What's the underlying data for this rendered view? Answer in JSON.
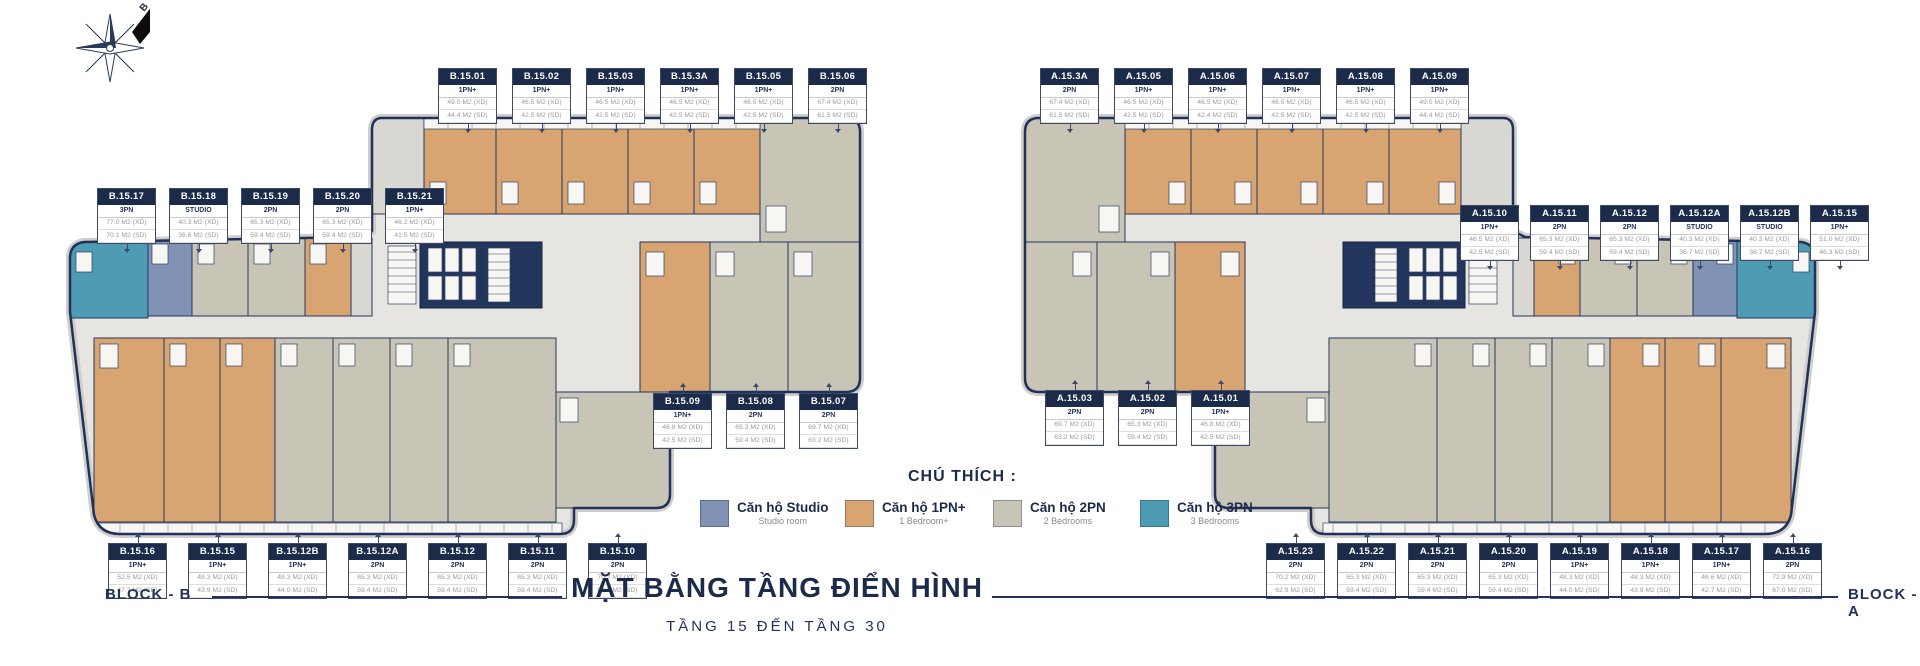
{
  "title": {
    "main": "MẶT BẰNG TẦNG ĐIỂN HÌNH",
    "subtitle": "TẦNG 15 ĐẾN TẦNG 30"
  },
  "compass": {
    "north_label": "B"
  },
  "legend": {
    "title": "CHÚ THÍCH :",
    "items": [
      {
        "name": "studio",
        "color": "#8093b4",
        "label_vi": "Căn hộ Studio",
        "label_en": "Studio room"
      },
      {
        "name": "1pn",
        "color": "#d8a471",
        "label_vi": "Căn hộ 1PN+",
        "label_en": "1 Bedroom+"
      },
      {
        "name": "2pn",
        "color": "#c9c5b6",
        "label_vi": "Căn hộ 2PN",
        "label_en": "2 Bedrooms"
      },
      {
        "name": "3pn",
        "color": "#4d9cb3",
        "label_vi": "Căn hộ 3PN",
        "label_en": "3 Bedrooms"
      }
    ]
  },
  "colors": {
    "accent_navy": "#1c2b4a",
    "wall": "#20315a"
  },
  "blocks": {
    "b": {
      "name": "BLOCK - B",
      "groups": {
        "top": [
          {
            "id": "B.15.01",
            "type": "1PN+",
            "area_xd": "49.0 M2 (XD)",
            "area_sd": "44.4 M2 (SD)"
          },
          {
            "id": "B.15.02",
            "type": "1PN+",
            "area_xd": "46.5 M2 (XD)",
            "area_sd": "42.5 M2 (SD)"
          },
          {
            "id": "B.15.03",
            "type": "1PN+",
            "area_xd": "46.5 M2 (XD)",
            "area_sd": "42.5 M2 (SD)"
          },
          {
            "id": "B.15.3A",
            "type": "1PN+",
            "area_xd": "46.5 M2 (XD)",
            "area_sd": "42.5 M2 (SD)"
          },
          {
            "id": "B.15.05",
            "type": "1PN+",
            "area_xd": "46.5 M2 (XD)",
            "area_sd": "42.5 M2 (SD)"
          },
          {
            "id": "B.15.06",
            "type": "2PN",
            "area_xd": "67.4 M2 (XD)",
            "area_sd": "61.5 M2 (SD)"
          }
        ],
        "left": [
          {
            "id": "B.15.17",
            "type": "3PN",
            "area_xd": "77.0 M2 (XD)",
            "area_sd": "70.1 M2 (SD)"
          },
          {
            "id": "B.15.18",
            "type": "STUDIO",
            "area_xd": "40.3 M2 (XD)",
            "area_sd": "36.6 M2 (SD)"
          },
          {
            "id": "B.15.19",
            "type": "2PN",
            "area_xd": "65.3 M2 (XD)",
            "area_sd": "59.4 M2 (SD)"
          },
          {
            "id": "B.15.20",
            "type": "2PN",
            "area_xd": "65.3 M2 (XD)",
            "area_sd": "59.4 M2 (SD)"
          },
          {
            "id": "B.15.21",
            "type": "1PN+",
            "area_xd": "46.2 M2 (XD)",
            "area_sd": "41.5 M2 (SD)"
          }
        ],
        "middle": [
          {
            "id": "B.15.09",
            "type": "1PN+",
            "area_xd": "46.8 M2 (XD)",
            "area_sd": "42.5 M2 (SD)"
          },
          {
            "id": "B.15.08",
            "type": "2PN",
            "area_xd": "65.3 M2 (XD)",
            "area_sd": "59.4 M2 (SD)"
          },
          {
            "id": "B.15.07",
            "type": "2PN",
            "area_xd": "69.7 M2 (XD)",
            "area_sd": "63.2 M2 (SD)"
          }
        ],
        "bottom": [
          {
            "id": "B.15.16",
            "type": "1PN+",
            "area_xd": "52.5 M2 (XD)",
            "area_sd": "47.7 M2 (SD)"
          },
          {
            "id": "B.15.15",
            "type": "1PN+",
            "area_xd": "48.3 M2 (XD)",
            "area_sd": "43.9 M2 (SD)"
          },
          {
            "id": "B.15.12B",
            "type": "1PN+",
            "area_xd": "48.3 M2 (XD)",
            "area_sd": "44.0 M2 (SD)"
          },
          {
            "id": "B.15.12A",
            "type": "2PN",
            "area_xd": "65.3 M2 (XD)",
            "area_sd": "59.4 M2 (SD)"
          },
          {
            "id": "B.15.12",
            "type": "2PN",
            "area_xd": "65.3 M2 (XD)",
            "area_sd": "59.4 M2 (SD)"
          },
          {
            "id": "B.15.11",
            "type": "2PN",
            "area_xd": "65.3 M2 (XD)",
            "area_sd": "59.4 M2 (SD)"
          },
          {
            "id": "B.15.10",
            "type": "2PN",
            "area_xd": "70.2 M2 (XD)",
            "area_sd": "62.9 M2 (SD)"
          }
        ]
      }
    },
    "a": {
      "name": "BLOCK - A",
      "groups": {
        "top": [
          {
            "id": "A.15.3A",
            "type": "2PN",
            "area_xd": "67.4 M2 (XD)",
            "area_sd": "61.5 M2 (SD)"
          },
          {
            "id": "A.15.05",
            "type": "1PN+",
            "area_xd": "46.5 M2 (XD)",
            "area_sd": "42.5 M2 (SD)"
          },
          {
            "id": "A.15.06",
            "type": "1PN+",
            "area_xd": "46.5 M2 (XD)",
            "area_sd": "42.4 M2 (SD)"
          },
          {
            "id": "A.15.07",
            "type": "1PN+",
            "area_xd": "46.5 M2 (XD)",
            "area_sd": "42.5 M2 (SD)"
          },
          {
            "id": "A.15.08",
            "type": "1PN+",
            "area_xd": "46.5 M2 (XD)",
            "area_sd": "42.5 M2 (SD)"
          },
          {
            "id": "A.15.09",
            "type": "1PN+",
            "area_xd": "49.0 M2 (XD)",
            "area_sd": "44.4 M2 (SD)"
          }
        ],
        "right": [
          {
            "id": "A.15.10",
            "type": "1PN+",
            "area_xd": "46.5 M2 (XD)",
            "area_sd": "42.5 M2 (SD)"
          },
          {
            "id": "A.15.11",
            "type": "2PN",
            "area_xd": "65.3 M2 (XD)",
            "area_sd": "59.4 M2 (SD)"
          },
          {
            "id": "A.15.12",
            "type": "2PN",
            "area_xd": "65.3 M2 (XD)",
            "area_sd": "59.4 M2 (SD)"
          },
          {
            "id": "A.15.12A",
            "type": "STUDIO",
            "area_xd": "40.3 M2 (XD)",
            "area_sd": "36.7 M2 (SD)"
          },
          {
            "id": "A.15.12B",
            "type": "STUDIO",
            "area_xd": "40.3 M2 (XD)",
            "area_sd": "36.7 M2 (SD)"
          },
          {
            "id": "A.15.15",
            "type": "1PN+",
            "area_xd": "51.0 M2 (XD)",
            "area_sd": "46.3 M2 (SD)"
          }
        ],
        "middle": [
          {
            "id": "A.15.03",
            "type": "2PN",
            "area_xd": "69.7 M2 (XD)",
            "area_sd": "63.2 M2 (SD)"
          },
          {
            "id": "A.15.02",
            "type": "2PN",
            "area_xd": "65.3 M2 (XD)",
            "area_sd": "59.4 M2 (SD)"
          },
          {
            "id": "A.15.01",
            "type": "1PN+",
            "area_xd": "46.8 M2 (XD)",
            "area_sd": "42.5 M2 (SD)"
          }
        ],
        "bottom": [
          {
            "id": "A.15.23",
            "type": "2PN",
            "area_xd": "70.2 M2 (XD)",
            "area_sd": "62.9 M2 (SD)"
          },
          {
            "id": "A.15.22",
            "type": "2PN",
            "area_xd": "65.3 M2 (XD)",
            "area_sd": "59.4 M2 (SD)"
          },
          {
            "id": "A.15.21",
            "type": "2PN",
            "area_xd": "65.3 M2 (XD)",
            "area_sd": "59.4 M2 (SD)"
          },
          {
            "id": "A.15.20",
            "type": "2PN",
            "area_xd": "65.3 M2 (XD)",
            "area_sd": "59.4 M2 (SD)"
          },
          {
            "id": "A.15.19",
            "type": "1PN+",
            "area_xd": "48.3 M2 (XD)",
            "area_sd": "44.0 M2 (SD)"
          },
          {
            "id": "A.15.18",
            "type": "1PN+",
            "area_xd": "48.3 M2 (XD)",
            "area_sd": "43.9 M2 (SD)"
          },
          {
            "id": "A.15.17",
            "type": "1PN+",
            "area_xd": "46.6 M2 (XD)",
            "area_sd": "42.7 M2 (SD)"
          },
          {
            "id": "A.15.16",
            "type": "2PN",
            "area_xd": "72.9 M2 (XD)",
            "area_sd": "67.0 M2 (SD)"
          }
        ]
      }
    }
  }
}
